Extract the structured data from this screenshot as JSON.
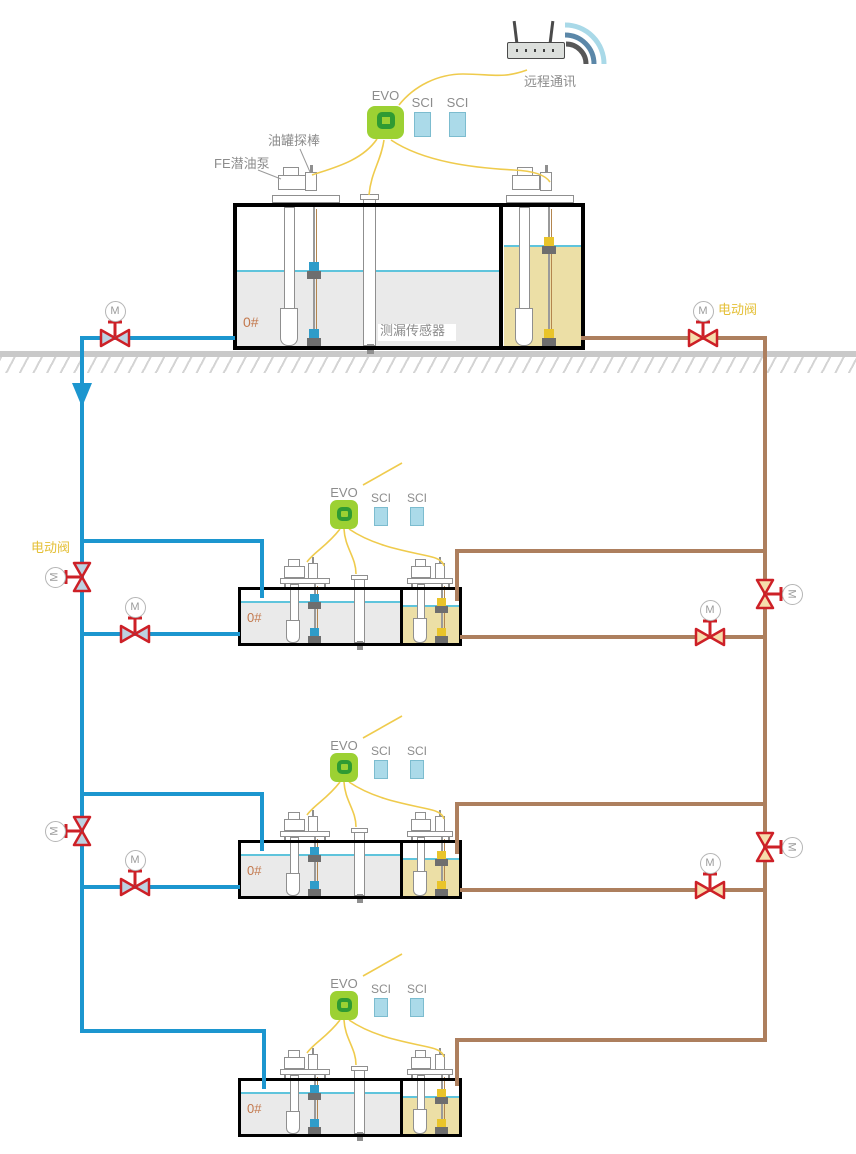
{
  "labels": {
    "remote_comm": "远程通讯",
    "evo": "EVO",
    "sci": "SCI",
    "tank_probe": "油罐探棒",
    "submersible_pump": "FE潜油泵",
    "leak_sensor": "测漏传感器",
    "electric_valve": "电动阀",
    "motor": "M",
    "fuel_grade": "0#"
  },
  "icons": {
    "router": "wifi-router-icon",
    "wireless": "wifi-arcs-icon",
    "controller": "evo-console-icon",
    "module": "sci-module-icon",
    "valve": "motor-valve-bowtie-icon",
    "pump": "submersible-pump-icon",
    "probe": "tank-probe-icon",
    "leak_sensor": "leak-sensor-tube-icon"
  },
  "colors": {
    "pipe_blue": "#1c96cf",
    "pipe_brown": "#ad7f5e",
    "wire_yellow": "#efcb4d",
    "valve_red": "#cd2027",
    "valve_fill_blue": "#bcd2e2",
    "valve_fill_tan": "#f6ddac",
    "evo_green": "#9cd133",
    "evo_ring": "#2f9b33",
    "sci_fill": "#abdae9",
    "sci_border": "#7cbccf",
    "diesel_fill": "#eaeaea",
    "gasoline_fill": "#ecdfa6",
    "liquid_surface": "#5fc4dc",
    "label_gray": "#8c8c8c",
    "grade_orange": "#c3794e",
    "gold_label": "#e4bf35",
    "ground_gray": "#c9c9c9",
    "outline_gray": "#8f8f8f",
    "float_blue": "#2f9cc9",
    "float_yellow": "#e9c42a",
    "float_gray": "#6e6e6e",
    "probe_wire": "#b3854e",
    "antenna_dark": "#4a4a4a",
    "wifi_outer": "#a9d9e8",
    "wifi_mid": "#5b87a8",
    "wifi_inner": "#575757"
  }
}
